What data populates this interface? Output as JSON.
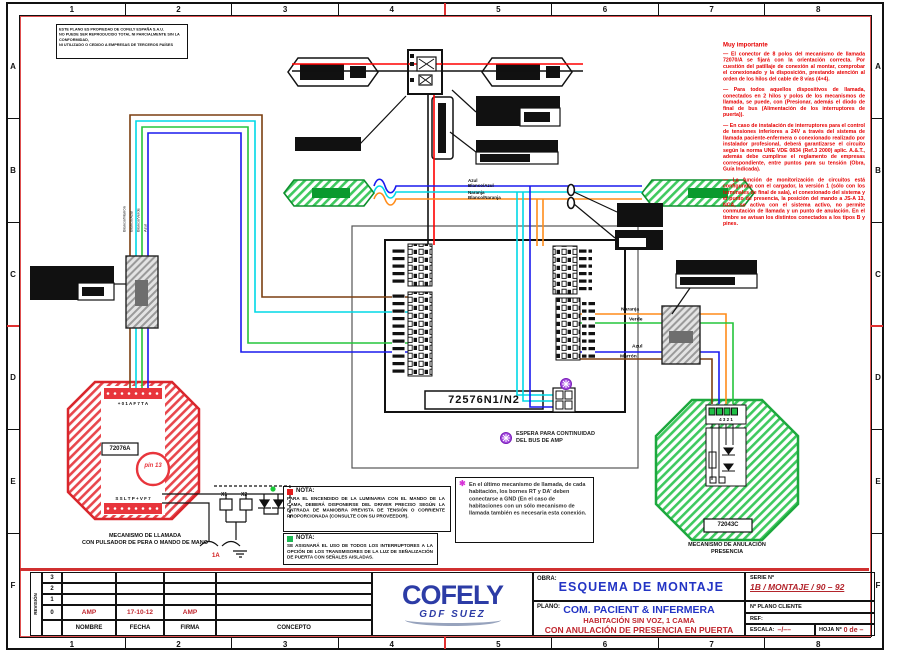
{
  "frame": {
    "cols": [
      "1",
      "2",
      "3",
      "4",
      "5",
      "6",
      "7",
      "8"
    ],
    "rows": [
      "A",
      "B",
      "C",
      "D",
      "E",
      "F"
    ]
  },
  "disclaimer": {
    "line1": "ESTE PLANO ES PROPIEDAD DE COFELY ESPAÑA S.A.U.",
    "line2": "NO PUEDE SER REPRODUCIDO TOTAL NI PARCIALMENTE SIN LA CONFORMIDAD,",
    "line3": "NI UTILIZADO O CEDIDO A EMPRESAS DE TERCEROS PAÍSES"
  },
  "important": {
    "title": "Muy importante",
    "p1": "— El conector de 8 polos del mecanismo de llamada 72070/A se fijará con la orientación correcta. Por cuestión del patillaje de conexión al montar, comprobar el conexionado y la disposición, prestando atención al orden de los hilos del cable de 8 vías (4+4).",
    "p2": "— Para todos aquellos dispositivos de llamada, conectados en 2 hilos y polos de los mecanismos de llamada, se puede, con (Presionar, además el diodo de final de bus (Alimentación de los interruptores de puerta)).",
    "p3": "— En caso de instalación de interruptores para el control de tensiones inferiores a 24V a través del sistema de llamada paciente-enfermera o conexionado realizado por instalador profesional, deberá garantizarse el circuito según la norma UNE VDE 0834 (Ref.3 2000) aplic. A.&.T., además debe cumplirse el reglamento de empresas correspondiente, entre puntos para su tensión (Obra, Guía Indicada).",
    "p4": "— La función de monitorización de circuitos está configurada con el cargador, la versión 1 (sólo con los terminales de final de sala), el conexionado del sistema y el punto de presencia, la posición del mando a JS-A 13, NCA, se activa con el sistema activo, no permite conmutación de llamada y un punto de anulación. En el timbre se avisan los distintos conectados a los tipos B y pines."
  },
  "mid": {
    "azul1": "Azul",
    "azul2": "Blanco/Azul",
    "nar1": "Naranja",
    "nar2": "Blanco/Naranja"
  },
  "loop": {
    "l1": "Blanco/Marrón",
    "l2": "Blanco/Azul",
    "l3": "Blanco/Verde",
    "l4": "Azul"
  },
  "right": {
    "orange": "Naranja",
    "green": "Verde",
    "blue": "Azul",
    "brown": "Marrón"
  },
  "unit": {
    "label": "72576N1/N2"
  },
  "bus": {
    "line1": "ESPERA PARA CONTINUIDAD",
    "line2": "DEL BUS DE AMP"
  },
  "call": {
    "top_terms": "+ 0 1 A F 7 T A",
    "label": "72076A",
    "pin": "pin 13",
    "bot_terms": "S S L T P + V F 7",
    "cap1": "MECANISMO DE LLAMADA",
    "cap2": "CON PULSADOR DE PERA O MANDO DE MANO"
  },
  "cancel": {
    "terms": "4 3 2 1",
    "label": "72043C",
    "cap1": "MECANISMO DE ANULACIÓN",
    "cap2": "PRESENCIA"
  },
  "circuit": {
    "x1": "X1",
    "x2": "X2",
    "tag": "1A"
  },
  "notes": {
    "n1_title": "NOTA:",
    "n1_text": "PARA EL ENCENDIDO DE LA LUMINARIA CON EL MANDO DE LA CAMA, DEBERÁ DISPONERSE DEL DRIVER PRECISO SEGÚN LA ENTRADA DE MANIOBRA PREVISTA DE TENSIÓN O CORRIENTE PROPORCIONADA (CONSULTE CON SU PROVEEDOR).",
    "n2_title": "NOTA:",
    "n2_text": "SE ASIGNARÁ EL USO DE TODOS LOS INTERRUPTORES A LA OPCIÓN DE LOS TRANSMISORES DE LA LUZ DE SEÑALIZACIÓN DE PUERTA CON SEÑALES AISLADAS.",
    "n3_text": "En el último mecanismo de llamada, de cada habitación, los bornes RT y DA' deben conectarse a GND (En el caso de habitaciones con un sólo mecanismo de llamada también es necesaria esta conexión."
  },
  "tb": {
    "obra_label": "OBRA:",
    "obra_value": "ESQUEMA DE MONTAJE",
    "serie_label": "SERIE Nº",
    "serie_value": "1B / MONTAJE / 90 – 92",
    "plano_label": "PLANO:",
    "plano_value": "COM. PACIENT & INFERMERA",
    "plano_sub1": "HABITACIÓN SIN VOZ, 1 CAMA",
    "plano_sub2": "CON ANULACIÓN DE PRESENCIA EN PUERTA",
    "nplano": "Nº PLANO CLIENTE",
    "ref": "REF:",
    "escala_label": "ESCALA:",
    "escala_value": "–/––",
    "hoja_label": "HOJA Nº",
    "hoja_value": "0 de –",
    "logo": "COFELY",
    "logo_sub": "GDF SUEZ"
  },
  "rev": {
    "side": "REVISIÓN",
    "r3": "3",
    "r2": "2",
    "r1": "1",
    "r0": "0",
    "nombre": "NOMBRE",
    "fecha": "FECHA",
    "firma": "FIRMA",
    "concepto": "CONCEPTO",
    "v_nombre": "AMP",
    "v_fecha": "17-10-12",
    "v_firma": "AMP"
  },
  "colors": {
    "wire_red": "#ff0000",
    "wire_blue": "#1a1aee",
    "wire_cyan": "#00d9e6",
    "wire_orange": "#ff8c1a",
    "wire_green": "#25c53b",
    "wire_brown": "#7b3f10",
    "device_red": "#d9262c",
    "device_green": "#1da83e",
    "brand_blue": "#2c3ca6",
    "title_red": "#c0262e",
    "marker_purple": "#a64ce0"
  }
}
